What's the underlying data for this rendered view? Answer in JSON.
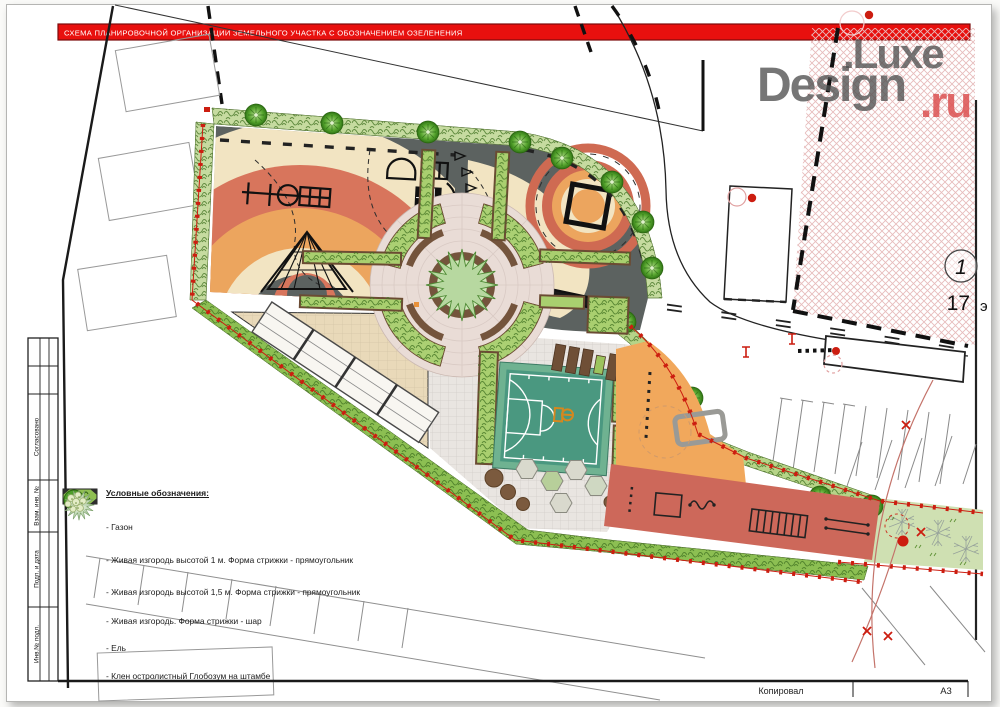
{
  "banner": {
    "title": "СХЕМА ПЛАНИРОВОЧНОЙ ОРГАНИЗАЦИИ ЗЕМЕЛЬНОГО УЧАСТКА С ОБОЗНАЧЕНИЕМ ОЗЕЛЕНЕНИЯ",
    "color": "#e8100e"
  },
  "watermark": {
    "line1": ".Luxe",
    "line2": "Design",
    "suffix": ".ru"
  },
  "stamp": {
    "labels": [
      "Согласовано",
      "Взам. инв. №",
      "Подп. и дата",
      "Инв.№ подл."
    ]
  },
  "plan": {
    "building_callout_number": "1",
    "building_floors": "17",
    "building_floors_suffix": "э"
  },
  "legend": {
    "heading": "Условные обозначения:",
    "items": [
      {
        "symbol": "lawn-swatch",
        "label": "- Газон"
      },
      {
        "symbol": "hedge-1m-swatch",
        "label": "- Живая изгородь высотой 1 м. Форма стрижки - прямоугольник"
      },
      {
        "symbol": "hedge-1-5m-swatch",
        "label": "- Живая изгородь высотой 1,5 м. Форма стрижки - прямоугольник"
      },
      {
        "symbol": "hedge-ball-symbol",
        "label": "- Живая изгородь. Форма стрижки - шар"
      },
      {
        "symbol": "spruce-symbol",
        "label": "- Ель"
      },
      {
        "symbol": "maple-symbol",
        "label": "- Клен остролистный Глобозум на штамбе"
      }
    ]
  },
  "footer": {
    "copied_by": "Копировал",
    "format": "А3"
  },
  "colors": {
    "banner_red": "#e8100e",
    "playground_gray": "#5c6260",
    "arc_red": "#d8755c",
    "arc_orange": "#eca55e",
    "sand_cream": "#f2e4c2",
    "hedge_light": "#c6dba0",
    "hedge_mid": "#a9cf6f",
    "hedge_dark": "#85b94e",
    "lawn_green": "#cfe0b2",
    "court_teal": "#4a9880",
    "workout_orange": "#f1a85c",
    "workout_red": "#cd685a",
    "bench_brown": "#74543c",
    "building_hatch_pink": "#e7bcbc",
    "fence_red": "#cc1d10"
  }
}
